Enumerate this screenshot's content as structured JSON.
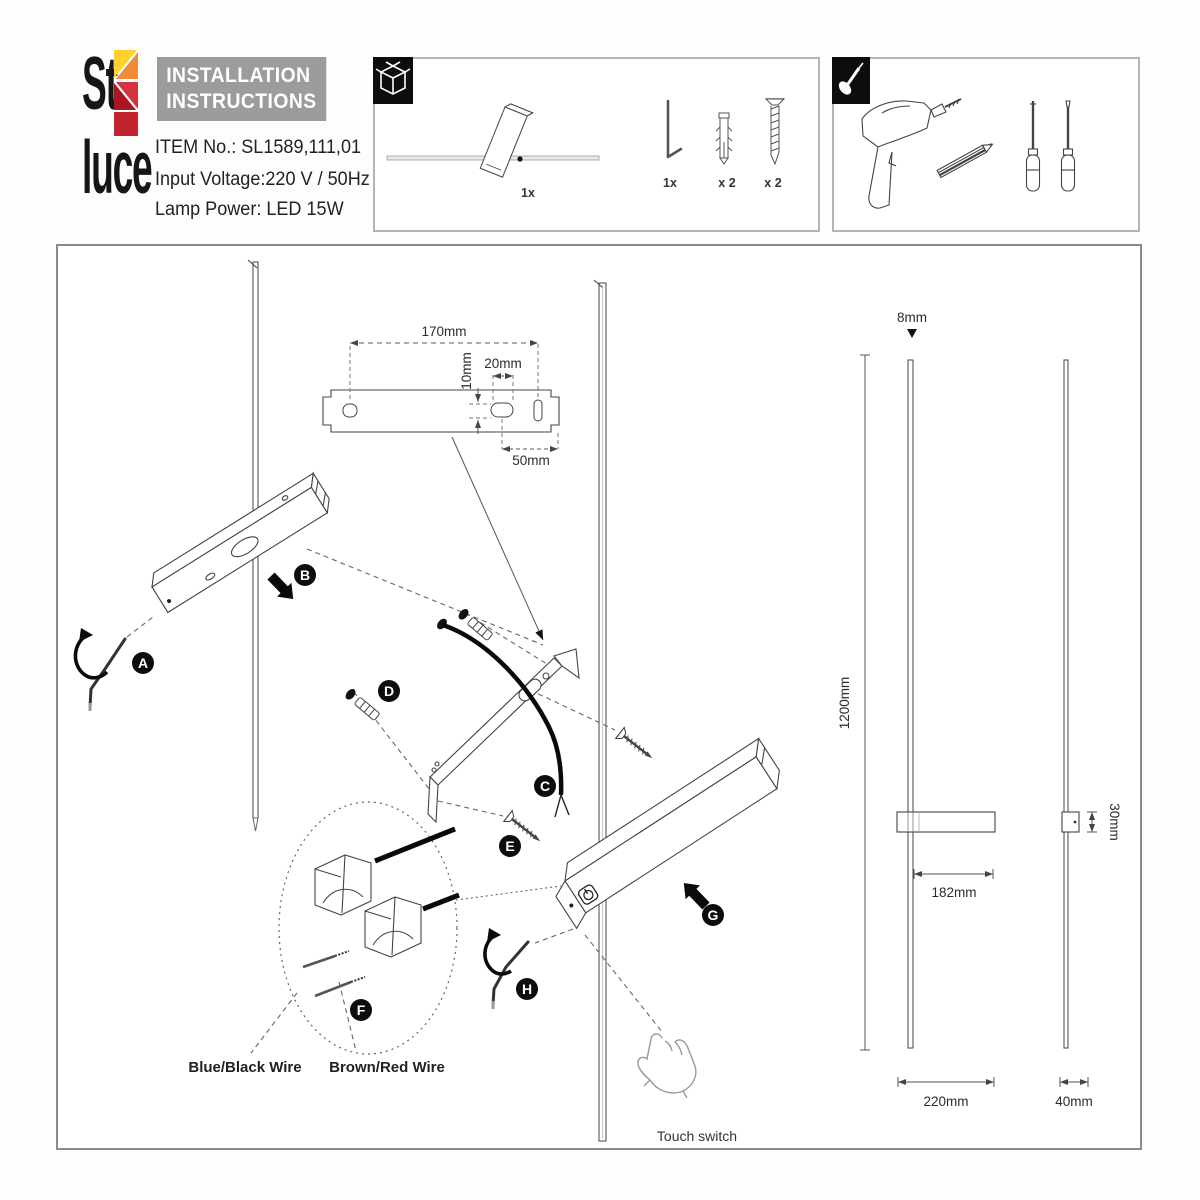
{
  "header": {
    "brand_line1": "St",
    "brand_line2": "luce",
    "title_line1": "INSTALLATION",
    "title_line2": "INSTRUCTIONS",
    "item_no": "ITEM No.: SL1589,111,01",
    "input_voltage": "Input Voltage:220 V / 50Hz",
    "lamp_power": "Lamp Power: LED 15W",
    "brand_colors": {
      "yellow": "#ffd12b",
      "orange": "#ef8b3a",
      "red": "#d4323e",
      "dark_red": "#a8161f",
      "crimson": "#c1242f"
    }
  },
  "package_box": {
    "icon": "package-icon",
    "lamp_qty": "1x",
    "allen_key_qty": "1x",
    "wall_plug_qty": "x 2",
    "screw_qty": "x 2"
  },
  "tools_box": {
    "icon": "screwdriver-icon",
    "tools": [
      "drill",
      "pencil",
      "phillips-screwdriver",
      "flat-screwdriver"
    ]
  },
  "bracket_template": {
    "width": "170mm",
    "hole_height": "10mm",
    "slot_width": "20mm",
    "end_offset": "50mm"
  },
  "steps": [
    "A",
    "B",
    "C",
    "D",
    "E",
    "F",
    "G",
    "H"
  ],
  "wiring": {
    "blue_label": "Blue/Black Wire",
    "brown_label": "Brown/Red Wire"
  },
  "labels": {
    "touch_switch": "Touch switch"
  },
  "dimensions": {
    "rod_diameter": "8mm",
    "total_height": "1200mm",
    "arm_length": "182mm",
    "bracket_depth": "30mm",
    "base_width": "220mm",
    "side_width": "40mm"
  }
}
